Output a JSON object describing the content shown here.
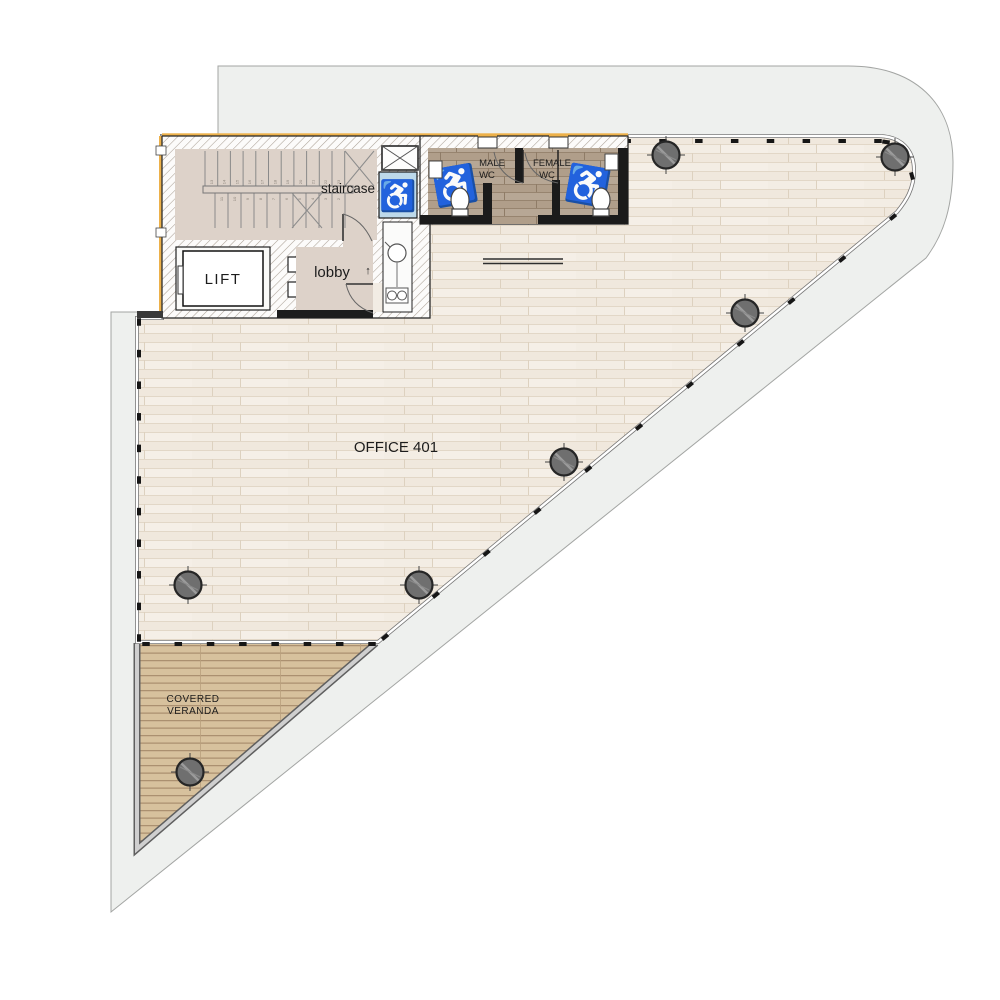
{
  "labels": {
    "office": "OFFICE 401",
    "staircase": "staircase",
    "lift": "LIFT",
    "lobby": "lobby",
    "male_wc_1": "MALE",
    "male_wc_2": "WC",
    "female_wc_1": "FEMALE",
    "female_wc_2": "WC",
    "veranda_1": "COVERED",
    "veranda_2": "VERANDA",
    "up_arrow": "↑",
    "wheelchair_icon": "♿"
  },
  "colors": {
    "site_gray": "#eef0ee",
    "site_edge": "#a3a5a3",
    "core_floor": "#ddd2c9",
    "office_base": "#f3ede4",
    "office_line": "#e4dacb",
    "wc_base": "#b7a795",
    "wc_line": "#9e8d7a",
    "deck_base": "#d7c19d",
    "deck_line": "#ad9371",
    "refuge_blue": "#bdd9ea",
    "refuge_icon": "#41769f",
    "insulation_yellow": "#edb14a",
    "wall_dark": "#1b1b1b",
    "glazing_gray": "#767676",
    "column_fill": "#6f6f6f",
    "column_edge": "#262626"
  },
  "columns": [
    {
      "x": 666,
      "y": 155
    },
    {
      "x": 895,
      "y": 157
    },
    {
      "x": 745,
      "y": 313
    },
    {
      "x": 564,
      "y": 462
    },
    {
      "x": 188,
      "y": 585
    },
    {
      "x": 419,
      "y": 585
    },
    {
      "x": 190,
      "y": 772
    }
  ],
  "glazing": {
    "tick_w": 7.5,
    "tick_h": 4,
    "segments": [
      {
        "x1": 448,
        "y1": 141,
        "x2": 878,
        "y2": 141,
        "n": 13
      },
      {
        "x1": 139,
        "y1": 322,
        "x2": 139,
        "y2": 638,
        "n": 11
      },
      {
        "x1": 146,
        "y1": 644,
        "x2": 372,
        "y2": 644,
        "n": 8
      },
      {
        "x1": 893,
        "y1": 217,
        "x2": 385,
        "y2": 637,
        "n": 11
      }
    ],
    "extra_ticks": [
      {
        "x": 886,
        "y": 142,
        "a": 8
      },
      {
        "x": 905,
        "y": 155,
        "a": 40
      },
      {
        "x": 912,
        "y": 176,
        "a": 75
      }
    ]
  },
  "stairs": {
    "upper": {
      "x0": 205,
      "y0": 151,
      "h": 35,
      "n": 12,
      "dx": 12.7
    },
    "lower": {
      "x0": 215,
      "y0": 193,
      "h": 35,
      "n": 11,
      "dx": 13.0
    },
    "upper_numbers": [
      "13",
      "14",
      "15",
      "16",
      "17",
      "18",
      "19",
      "20",
      "21",
      "22",
      "23"
    ],
    "lower_numbers": [
      "11",
      "10",
      "9",
      "8",
      "7",
      "6",
      "5",
      "4",
      "3",
      "2",
      "1"
    ]
  }
}
